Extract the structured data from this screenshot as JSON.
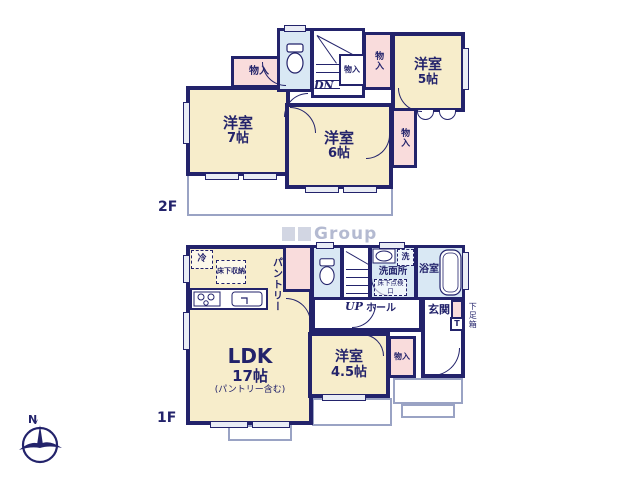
{
  "colors": {
    "wall": "#23236B",
    "ink": "#23236B",
    "room": "#F7EDCB",
    "closet": "#F9DCDC",
    "wet": "#D9E8F4",
    "window": "#E9ECF5",
    "outline": "#9AA3C4",
    "wm": "#9BA4C2"
  },
  "watermark": "Group",
  "compass": {
    "label": "N"
  },
  "floor2": {
    "label": "2F",
    "room7": {
      "name": "洋室",
      "size": "7帖"
    },
    "room6": {
      "name": "洋室",
      "size": "6帖"
    },
    "room5": {
      "name": "洋室",
      "size": "5帖"
    },
    "closet_top": "物入",
    "closet_stairs": "物入",
    "closet_right_of_stairs": "物入",
    "closet_right_of_room6": "物入",
    "stairs_label": "DN"
  },
  "floor1": {
    "label": "1F",
    "ldk": {
      "name": "LDK",
      "size": "17帖",
      "note": "(パントリー含む)"
    },
    "room45": {
      "name": "洋室",
      "size": "4.5帖"
    },
    "fridge": "冷",
    "floor_storage": "床下収納",
    "pantry": "パントリー",
    "stairs_label": "UP",
    "washroom": "洗面所",
    "laundry": "洗",
    "inspection_hatch": "床下点検口",
    "bathroom": "浴室",
    "hall": "ホール",
    "entrance": "玄関",
    "shoe_box": "下足箱",
    "shoe_box_t": "T",
    "closet": "物入"
  }
}
